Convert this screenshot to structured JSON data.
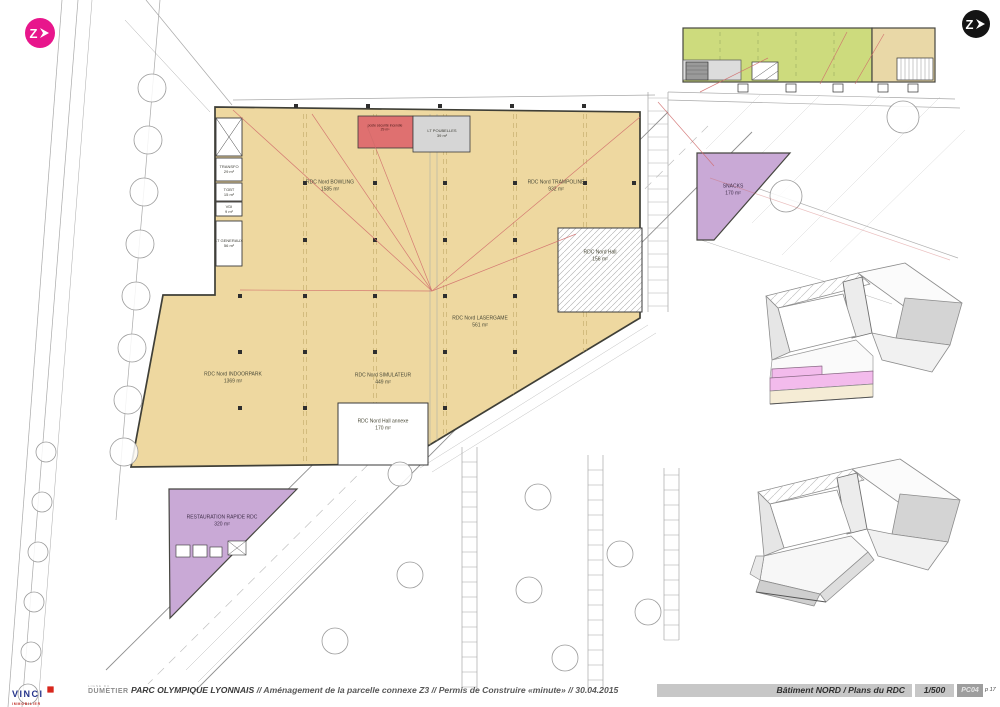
{
  "logos": {
    "architect_glyph": "Z"
  },
  "plan": {
    "rooms": {
      "bowling": {
        "name": "RDC Nord BOWLING",
        "area": "1585 m²"
      },
      "trampoline": {
        "name": "RDC Nord TRAMPOLINE",
        "area": "932 m²"
      },
      "lasergame": {
        "name": "RDC Nord LASERGAME",
        "area": "561 m²"
      },
      "indoorpark": {
        "name": "RDC Nord INDOORPARK",
        "area": "1369 m²"
      },
      "simulateur": {
        "name": "RDC Nord SIMULATEUR",
        "area": "449 m²"
      },
      "hall": {
        "name": "RDC Nord Hall",
        "area": "156 m²"
      },
      "hall_annexe": {
        "name": "RDC Nord Hall annexe",
        "area": "170 m²"
      },
      "snacks": {
        "name": "SNACKS",
        "area": "170 m²"
      },
      "restauration": {
        "name": "RESTAURATION RAPIDE RDC",
        "area": "320 m²"
      },
      "transfo": {
        "name": "TRANSFO",
        "area": "29 m²"
      },
      "tgbt": {
        "name": "TGBT",
        "area": "15 m²"
      },
      "vdi": {
        "name": "VDI",
        "area": "9 m²"
      },
      "lt_generaux": {
        "name": "LT GENERAUX",
        "area": "56 m²"
      },
      "lt_poubelles": {
        "name": "LT POUBELLES",
        "area": "39 m²"
      },
      "poste_securite": {
        "name": "poste sécurité incendie",
        "area": "29 m²"
      }
    },
    "colors": {
      "leisure_fill": "#eed8a0",
      "restaurant_fill": "#c9a9d6",
      "commerce_fill": "#cddb7d",
      "technical_red": "#df7070",
      "highlight_pink": "#f3bbec"
    }
  },
  "footer": {
    "vinci": "VINCI",
    "vinci_sub": "IMMOBILIER",
    "dumetier_top": "LIGNE DU",
    "dumetier": "DUMETIER",
    "title_project": "PARC OLYMPIQUE LYONNAIS",
    "title_rest": "// Aménagement de la parcelle connexe Z3 // Permis de Construire «minute» // 30.04.2015",
    "sheet_name": "Bâtiment NORD  / Plans du RDC",
    "scale": "1/500",
    "doc_code": "PC04",
    "page": "p 17"
  }
}
